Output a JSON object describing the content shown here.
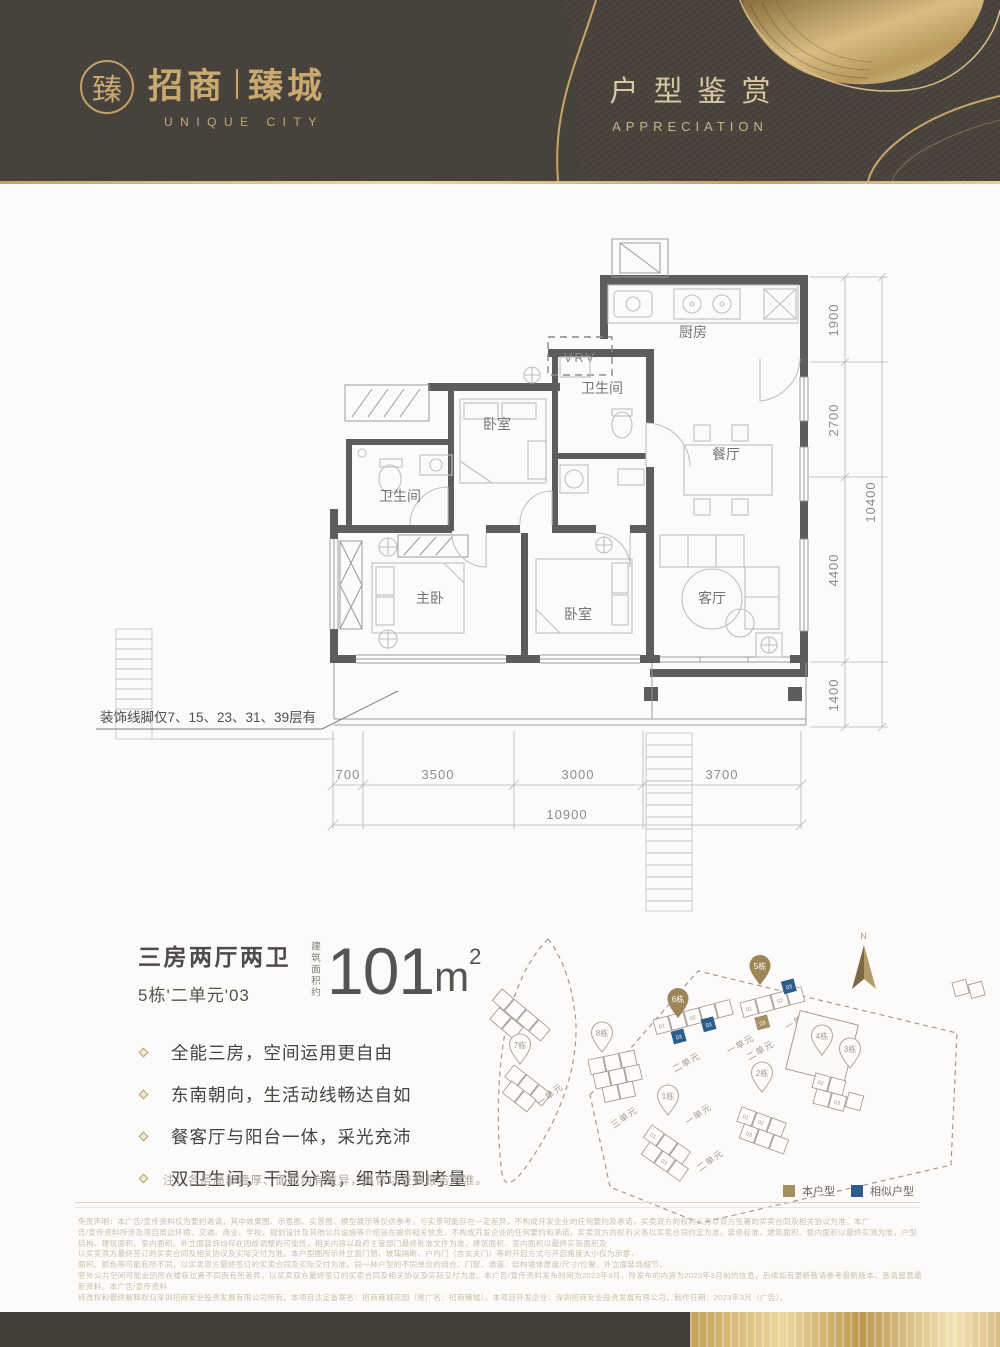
{
  "header": {
    "logo_glyph": "臻",
    "brand_cn_1": "招商",
    "brand_cn_2": "臻城",
    "brand_en": "UNIQUE CITY",
    "title": "户型鉴赏",
    "subtitle": "APPRECIATION"
  },
  "plan": {
    "rooms": {
      "kitchen": "厨房",
      "dining": "餐厅",
      "bath_right": "卫生间",
      "bath_left": "卫生间",
      "bedroom_top": "卧室",
      "bedroom_mid": "卧室",
      "master": "主卧",
      "living": "客厅"
    },
    "vrv": "VRV",
    "annotation": "装饰线脚仅7、15、23、31、39层有",
    "dims_right": [
      "1900",
      "2700",
      "4400",
      "1400"
    ],
    "dims_right_total": "10400",
    "dims_bottom": [
      "700",
      "3500",
      "3000",
      "3700"
    ],
    "dims_bottom_total": "10900"
  },
  "info": {
    "layout": "三房两厅两卫",
    "unit": "5栋'二单元'03",
    "area_label": "建筑面积约",
    "area_value": "101",
    "area_unit": "m",
    "area_exp": "2",
    "bullets": [
      "全能三房，空间运用更自由",
      "东南朝向，生活动线畅达自如",
      "餐客厅与阳台一体，采光充沛",
      "双卫生间，干湿分离，细节周到考量"
    ],
    "note": "注：各层局部墙厚、面积均有差异，具体以查账报告为准。"
  },
  "siteplan": {
    "north": "N",
    "markers": {
      "b1": "1栋",
      "b2": "2栋",
      "b3": "3栋",
      "b4": "4栋",
      "b5": "5栋",
      "b6": "6栋",
      "b7": "7栋",
      "b8": "8栋"
    },
    "units": {
      "u_left": "一单元",
      "u8": "三单元",
      "u6a": "二单元",
      "u6b": "一单元",
      "u1a": "一单元",
      "u1b": "二单元",
      "u5a": "二单元",
      "u5b": "一单元"
    },
    "unit_numbers": [
      "01",
      "02",
      "03"
    ],
    "legend": [
      {
        "label": "本户型",
        "color": "#a5905f"
      },
      {
        "label": "相似户型",
        "color": "#2d5d8a"
      }
    ]
  },
  "colors": {
    "brand_gold": "#c9a96d",
    "header_dark": "#48423c",
    "wall_gray": "#5e5d5d",
    "highlight_gold": "#a5905f",
    "similar_blue": "#2d5d8a"
  },
  "disclaimer": {
    "lines": [
      "免责声明：本广告/宣传资料仅为要约邀请，其中效果图、示意图、实景图、模型展示等仅供参考，与实景可能存在一定差异，不构成开发企业的任何要约及承诺，买卖双方的权利义务以双方签署的买卖合同及相关协议为准。本广",
      "告/宣传资料所涉及项目周边环境、交通、商业、学校、规划设计及其他公共设施等介绍旨在提供相关信息，不构成开发企业的任何要约和承诺，买卖双方的权利义务以买卖合同约定为准。装修标准、建筑面积、套内面积以最终实测为准，户型",
      "结构、建筑面积、室内面积、外立面装饰均存在因故调整的可能性，相关内容以政府主管部门最终批准文件为准，建筑面积、室内面积以最终实测面积及",
      "以买卖双方最终签订的买卖合同及相关协议及实际交付为准。本户型图所示外立面门窗、玻璃隔断、户内门（含玄关门）等的开启方式与开启角度大小仅为示意，",
      "面积、颜色等可能有所不同，以买卖双方最终签订的买卖合同及实际交付为准。同一种户型的不同单位的组合、门窗、通道、结构墙体厚度/尺寸/位置、外立面装饰细节、",
      "室外公共空间可能会因所在楼栋位置不同而有所差异，以买卖双方最终签订的买卖合同及相关协议及实际交付为准。本广告/宣传资料发布时间为2023年3月，所发布的内容为2023年3月前的信息，后续如有更新敬请参考最新版本，恳请留意最新资料。本广告/宣传资料",
      "修改权和最终解释权归深圳招商安业投资发展有限公司所有。本项目法定备案名：招商雍城花园（推广名：招商臻城），本项目开发企业：深圳招商安业投资发展有限公司，制作日期：2023年3月（广告）。"
    ]
  }
}
